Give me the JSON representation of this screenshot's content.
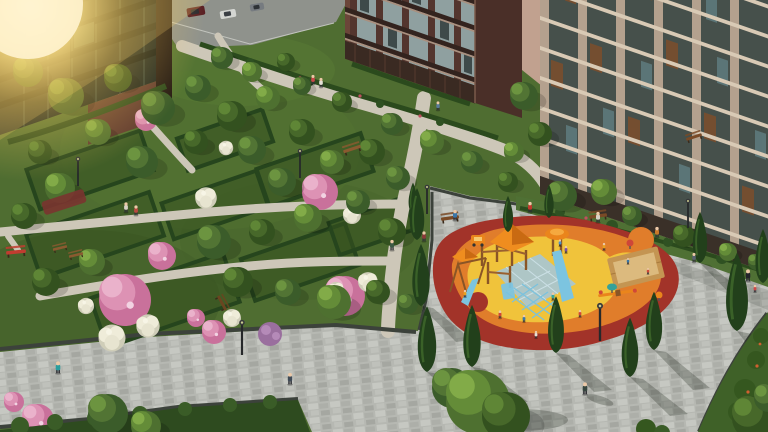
{
  "scene": {
    "title": "Aerial rendering of a residential courtyard with landscaped gardens and a children's playground",
    "buildings": [
      "glass-facade tower at top left with bright sun glare",
      "brown brick apartment block with glazed balconies at top center",
      "tall beige apartment building with glazed balconies on the right"
    ],
    "landscape": [
      "formal hedge-bordered garden beds",
      "pink flowering trees",
      "white hydrangea shrubs",
      "lilac bush",
      "conical thuja trees",
      "lawns with shrub borders"
    ],
    "hardscape": [
      "stone-paved promenade and plaza with dark granite edging",
      "gravel garden paths",
      "access road with three parked cars at top"
    ],
    "playground": [
      "rubber safety surface in red, orange and yellow blobs",
      "pale-blue grid patch",
      "wooden climbing towers with orange pyramid roofs",
      "blue slides and climbing net",
      "sandbox with timber border",
      "seesaw and spring riders",
      "children playing, adults watching from benches"
    ],
    "furniture": [
      "park benches",
      "red bench at left edge",
      "black street lamps"
    ],
    "people": "residents walking the paths and promenade"
  },
  "palette": {
    "grass": "#4f6d31",
    "grassDark": "#3c5824",
    "grassLight": "#5d8038",
    "lawn": "#4f7034",
    "hedge": "#2b4a1d",
    "pave": "#b6b8b2",
    "paveEdge": "#3c423b",
    "gravel": "#cdc7b8",
    "road": "#8f928c",
    "red": "#a23329",
    "orange": "#e07d2b",
    "yellow": "#f0c33b",
    "blue": "#a6c7d6",
    "brick": "#6b4539",
    "brickDark": "#50342c",
    "beige": "#b4a18e",
    "glass": "#1b2522",
    "cone": "#22401b",
    "sand": "#dcba7e",
    "sandWood": "#c49552",
    "wood": "#8a5526",
    "equipOrange": "#ea851c",
    "slideBlue": "#7cc4e0",
    "pinkBloom": "#cf7ba3",
    "whiteBloom": "#eeebd9",
    "flare": "#ffe284",
    "benchRed": "#c13c30",
    "benchWood": "#7a4a26"
  }
}
